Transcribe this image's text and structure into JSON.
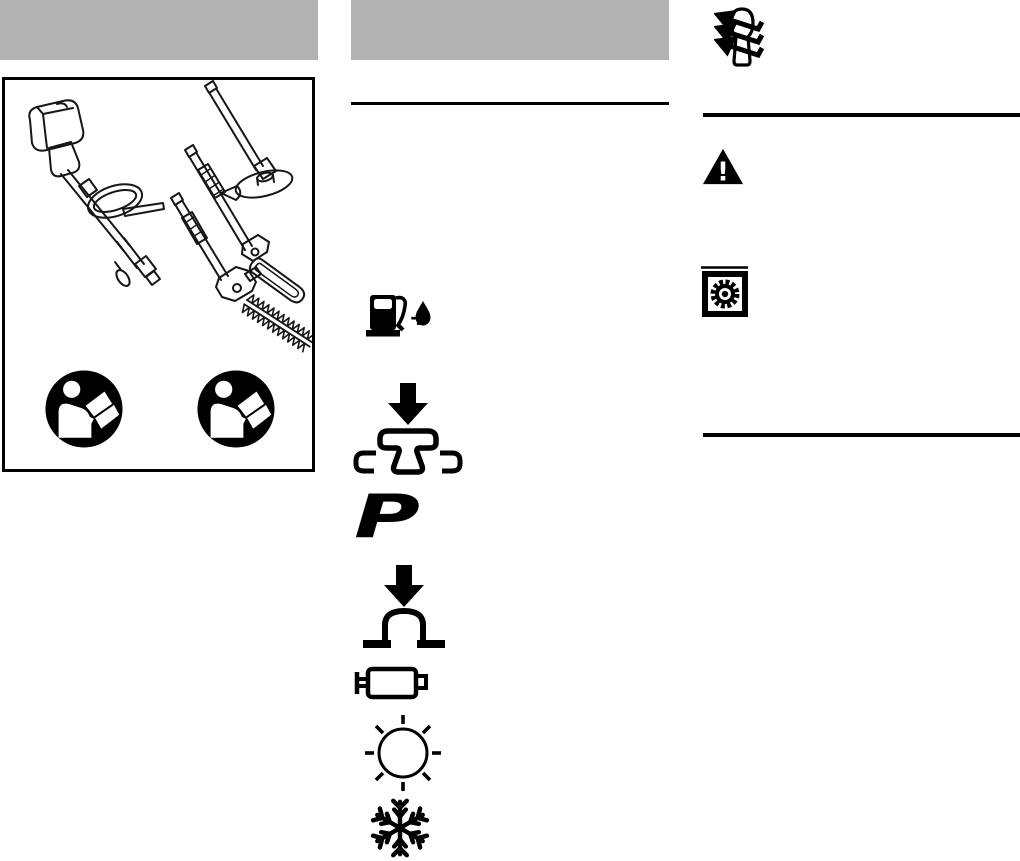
{
  "page": {
    "kind": "power-tool-manual-symbols-page",
    "paper": "#ffffff"
  },
  "colors": {
    "header_bar": "#b2b2b2",
    "ink": "#000000",
    "figure_line": "#161616"
  },
  "left_column": {
    "header_bar": {
      "name": "section-header-bar",
      "color": "#b2b2b2"
    },
    "figure": {
      "name": "kombi-engine-and-attachments-figure",
      "parts": [
        "engine-unit-with-loop-handle",
        "brushcutter-attachment",
        "pole-pruner-attachment",
        "hedge-trimmer-attachment"
      ],
      "badges": [
        {
          "name": "read-manual-icon"
        },
        {
          "name": "read-manual-icon"
        }
      ]
    }
  },
  "middle_column": {
    "header_bar": {
      "name": "section-header-bar",
      "color": "#b2b2b2"
    },
    "pictograms": [
      {
        "name": "fuel-oil-mix-icon",
        "plus_glyph": "+"
      },
      {
        "name": "press-coupling-icon"
      },
      {
        "name": "primer-pump-icon",
        "glyph": "P"
      },
      {
        "name": "press-primer-bulb-icon"
      },
      {
        "name": "muffler-icon"
      },
      {
        "name": "sun-summer-mode-icon"
      },
      {
        "name": "snowflake-winter-mode-icon"
      }
    ]
  },
  "right_column": {
    "pictograms": [
      {
        "name": "wrap-direction-arrows-icon"
      },
      {
        "name": "warning-triangle-icon",
        "glyph": "!"
      },
      {
        "name": "gear-in-frame-icon"
      }
    ]
  }
}
